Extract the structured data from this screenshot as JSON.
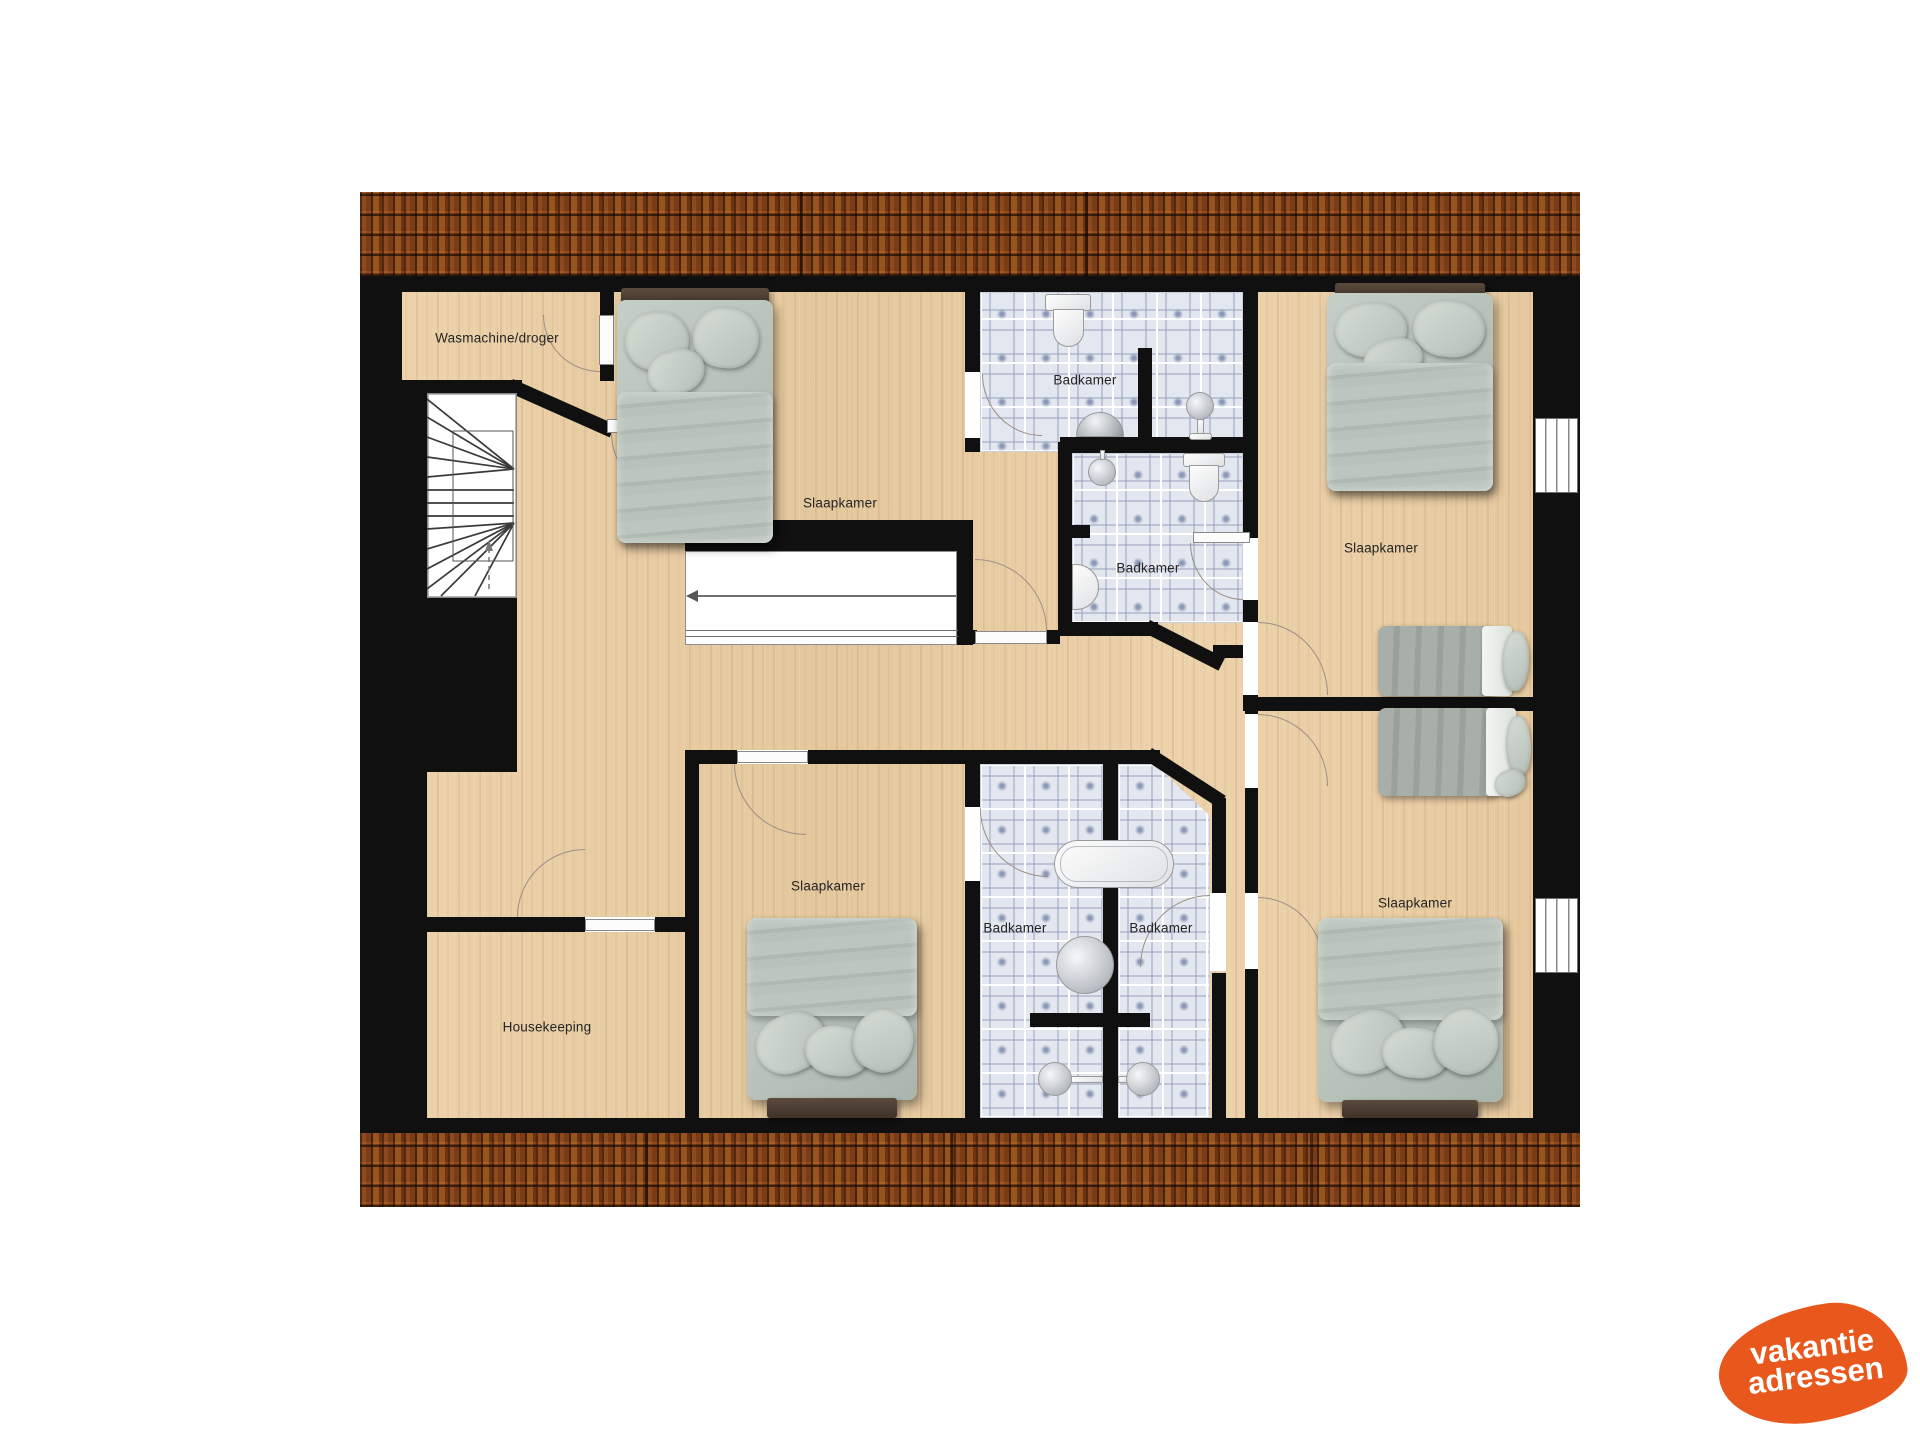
{
  "floorplan": {
    "rooms": {
      "laundry": {
        "label": "Wasmachine/droger"
      },
      "bedroom_top_center": {
        "label": "Slaapkamer"
      },
      "bathroom_top": {
        "label": "Badkamer"
      },
      "bathroom_middle": {
        "label": "Badkamer"
      },
      "bedroom_top_right": {
        "label": "Slaapkamer"
      },
      "bedroom_bottom_center": {
        "label": "Slaapkamer"
      },
      "bathroom_bottom_left": {
        "label": "Badkamer"
      },
      "bathroom_bottom_right": {
        "label": "Badkamer"
      },
      "bedroom_bottom_right": {
        "label": "Slaapkamer"
      },
      "housekeeping": {
        "label": "Housekeeping"
      }
    },
    "colors": {
      "wall": "#101010",
      "wood_floor": "#ead0a7",
      "bathroom_tile": "#e3e7ef",
      "roof_tile": "#7a3c15",
      "bed_linen": "#b6c1b9",
      "logo_orange": "#e8581c"
    }
  },
  "logo": {
    "line1": "vakantie",
    "line2": "adressen"
  }
}
